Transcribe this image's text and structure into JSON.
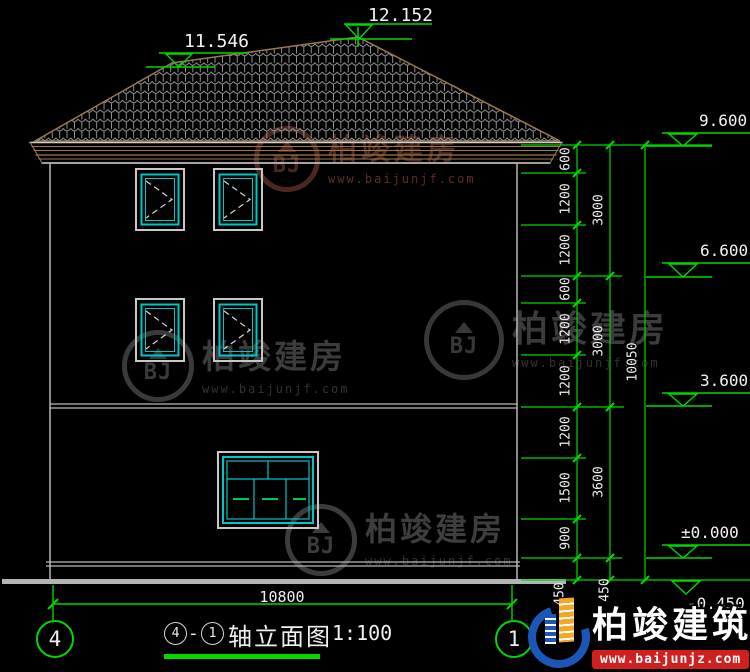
{
  "levels": {
    "peak": "12.152",
    "hip": "11.546",
    "eave": "9.600",
    "floor3": "6.600",
    "floor2": "3.600",
    "zero": "±0.000",
    "ground": "-0.450"
  },
  "dims": {
    "inner": [
      "600",
      "1200",
      "1200",
      "600",
      "1200",
      "1200",
      "1200",
      "1500",
      "900",
      "450"
    ],
    "mid": [
      "3000",
      "3000",
      "3600",
      "450"
    ],
    "right_total": "10050",
    "bottom_total": "10800"
  },
  "axes": {
    "left": "4",
    "right": "1"
  },
  "title": {
    "axis_start": "4",
    "dash": "-",
    "axis_end": "1",
    "name": "轴立面图",
    "scale": "1:100"
  },
  "watermark": {
    "monogram": "BJ",
    "brand": "柏竣建房",
    "url": "www.baijunjf.com"
  },
  "footer_logo": {
    "brand": "柏竣建筑",
    "url": "www.baijunjz.com"
  },
  "colors": {
    "background": "#000000",
    "dimension_green": "#00d800",
    "window_cyan": "#00c6c6",
    "roof_brown": "#9b7950",
    "line_gray": "#c4c4c4",
    "logo_blue": "#1a57b8",
    "logo_orange": "#f5a623",
    "strip_red": "#d01f1f"
  }
}
